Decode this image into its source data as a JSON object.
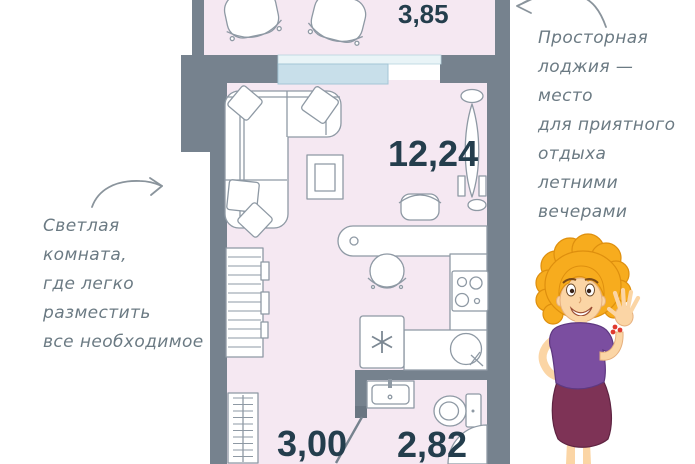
{
  "plan": {
    "areas": {
      "loggia": "3,85",
      "room": "12,24",
      "hall": "3,00",
      "bathroom": "2,82"
    }
  },
  "annotations": {
    "left": {
      "lines": [
        "Светлая",
        "комната,",
        "где легко",
        "разместить",
        "все необходимое"
      ]
    },
    "right": {
      "lines": [
        "Просторная",
        "лоджия —",
        "место",
        "для приятного",
        "отдыха",
        "летними",
        "вечерами"
      ]
    }
  },
  "colors": {
    "wall": "#76828E",
    "floor": "#F5E8F2",
    "window": "#C8DFEA",
    "area_label": "#243E4D",
    "annotation_text": "#6B7A83",
    "mascot_hair": "#F7AC1E",
    "mascot_blouse": "#7B4EA0",
    "mascot_skirt": "#7E3356"
  }
}
